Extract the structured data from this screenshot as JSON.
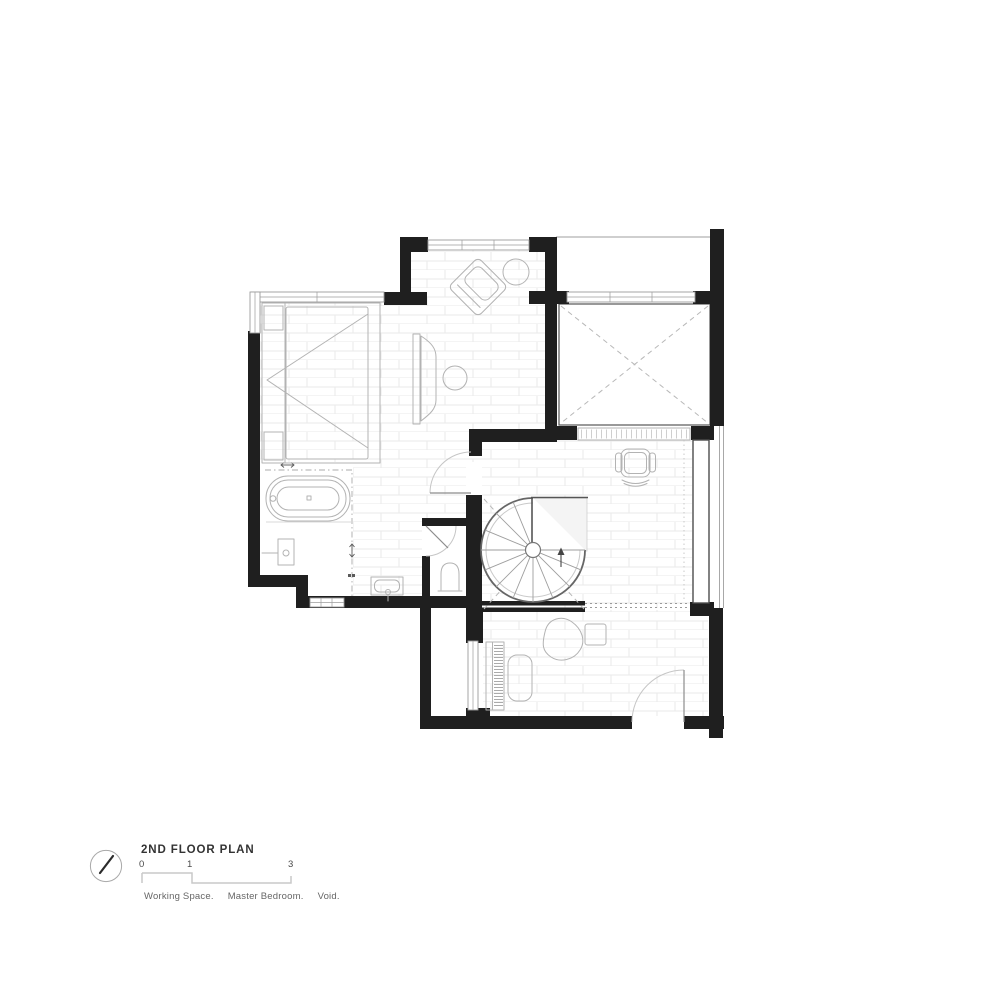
{
  "title_block": {
    "north_icon": "north-arrow-icon",
    "title": "2ND FLOOR PLAN",
    "scale": {
      "ticks": [
        "0",
        "1",
        "3"
      ]
    },
    "legend": {
      "items": [
        "Working Space.",
        "Master Bedroom.",
        "Void."
      ]
    }
  },
  "colors": {
    "background": "#ffffff",
    "wall": "#1f1f1f",
    "furniture_line": "#b3b3b3",
    "detail_line": "#8c8c8c",
    "floor_line": "#eaeaea",
    "void_line": "#b8b8b8",
    "title_text": "#333333",
    "legend_text": "#666666",
    "scale_text": "#4a4a4a",
    "scale_bar": "#c9c9c9"
  }
}
